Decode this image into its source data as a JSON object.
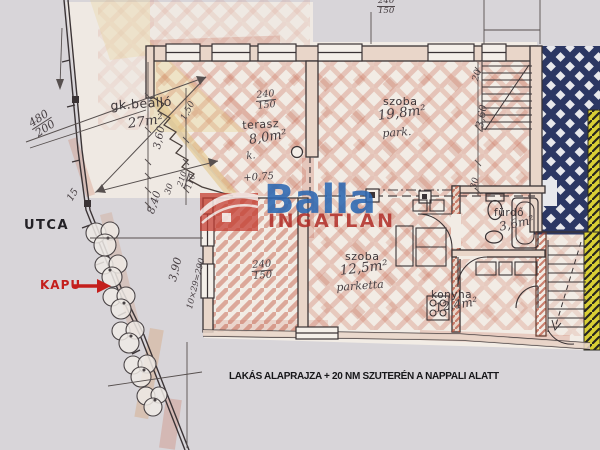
{
  "brand": {
    "name": "Balla",
    "subtitle": "INGATLAN",
    "blue": "#2b66b1",
    "red": "#b02c26"
  },
  "labels": {
    "street": "UTCA",
    "gate": "KAPU",
    "caption": "LAKÁS ALAPRAJZA + 20 NM SZUTERÉN A NAPPALI ALATT",
    "level_mark": "+0,75"
  },
  "rooms": {
    "parking": {
      "name": "gk.beálló",
      "area": "27m²"
    },
    "terrace": {
      "name": "terasz",
      "area": "8,0m²",
      "floor": "k."
    },
    "room_large": {
      "name": "szoba",
      "area": "19,8m²",
      "floor": "park."
    },
    "room_small": {
      "name": "szoba",
      "area": "12,5m²",
      "floor": "parketta"
    },
    "bathroom": {
      "name": "fürdő",
      "area": "3,6m²"
    },
    "kitchen": {
      "name": "konyha",
      "area": "12,4m²"
    }
  },
  "dimensions": {
    "site_width": {
      "num": "480",
      "den": "200"
    },
    "terrace_door": {
      "num": "240",
      "den": "150"
    },
    "room_small_door": {
      "num": "240",
      "den": "150"
    },
    "top_door": {
      "num": "240",
      "den": "150"
    },
    "hall_door": {
      "num": "210",
      "den": "110"
    },
    "depth_left": "3,60",
    "depth_right": "3,60",
    "width_left": "8,40",
    "gate_width": "3,90",
    "stair_steps": "10×29=290",
    "fence_mark": "15",
    "d150": "1,50",
    "d30_left": "30",
    "d30_right": "30",
    "d20_right": "20"
  },
  "colors": {
    "lattice_navy": "#2c3763",
    "hatch_yellow": "#d9cf35",
    "gate_red": "#c41f1c",
    "plan_paper": "#f2ebe4",
    "background": "#d8d5d9"
  }
}
